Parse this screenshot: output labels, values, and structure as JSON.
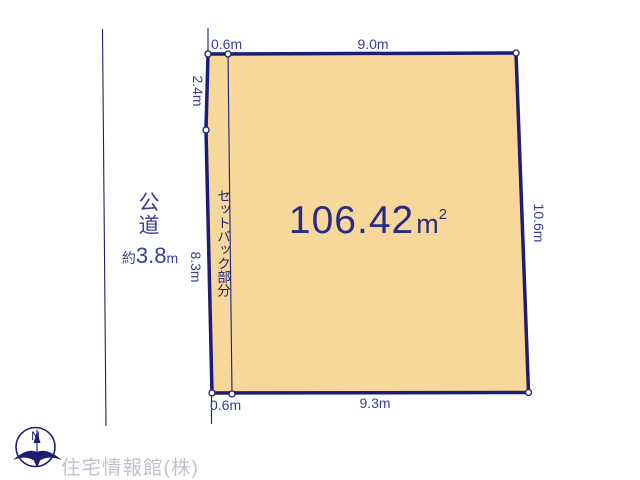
{
  "colors": {
    "navy": "#1d1d75",
    "indigo": "#383d9b",
    "area-navy": "#272c80",
    "fill": "#f8d79a",
    "muted": "#c2c1cc",
    "bg": "#ffffff"
  },
  "plot": {
    "area_value": "106.42",
    "area_unit": "m",
    "area_unit_exp": "2",
    "dimensions": {
      "top_setback": "0.6m",
      "top": "9.0m",
      "left_upper": "2.4m",
      "left_lower": "8.3m",
      "right": "10.6m",
      "bottom_setback": "0.6m",
      "bottom": "9.3m"
    },
    "setback_label": "セットバック部分"
  },
  "road": {
    "name": "公道",
    "width_prefix": "約",
    "width_value": "3.8",
    "width_unit": "m"
  },
  "compass": {
    "icon_name": "compass-north-icon",
    "north_label": "N"
  },
  "footer": {
    "company": "住宅情報館(株)"
  }
}
